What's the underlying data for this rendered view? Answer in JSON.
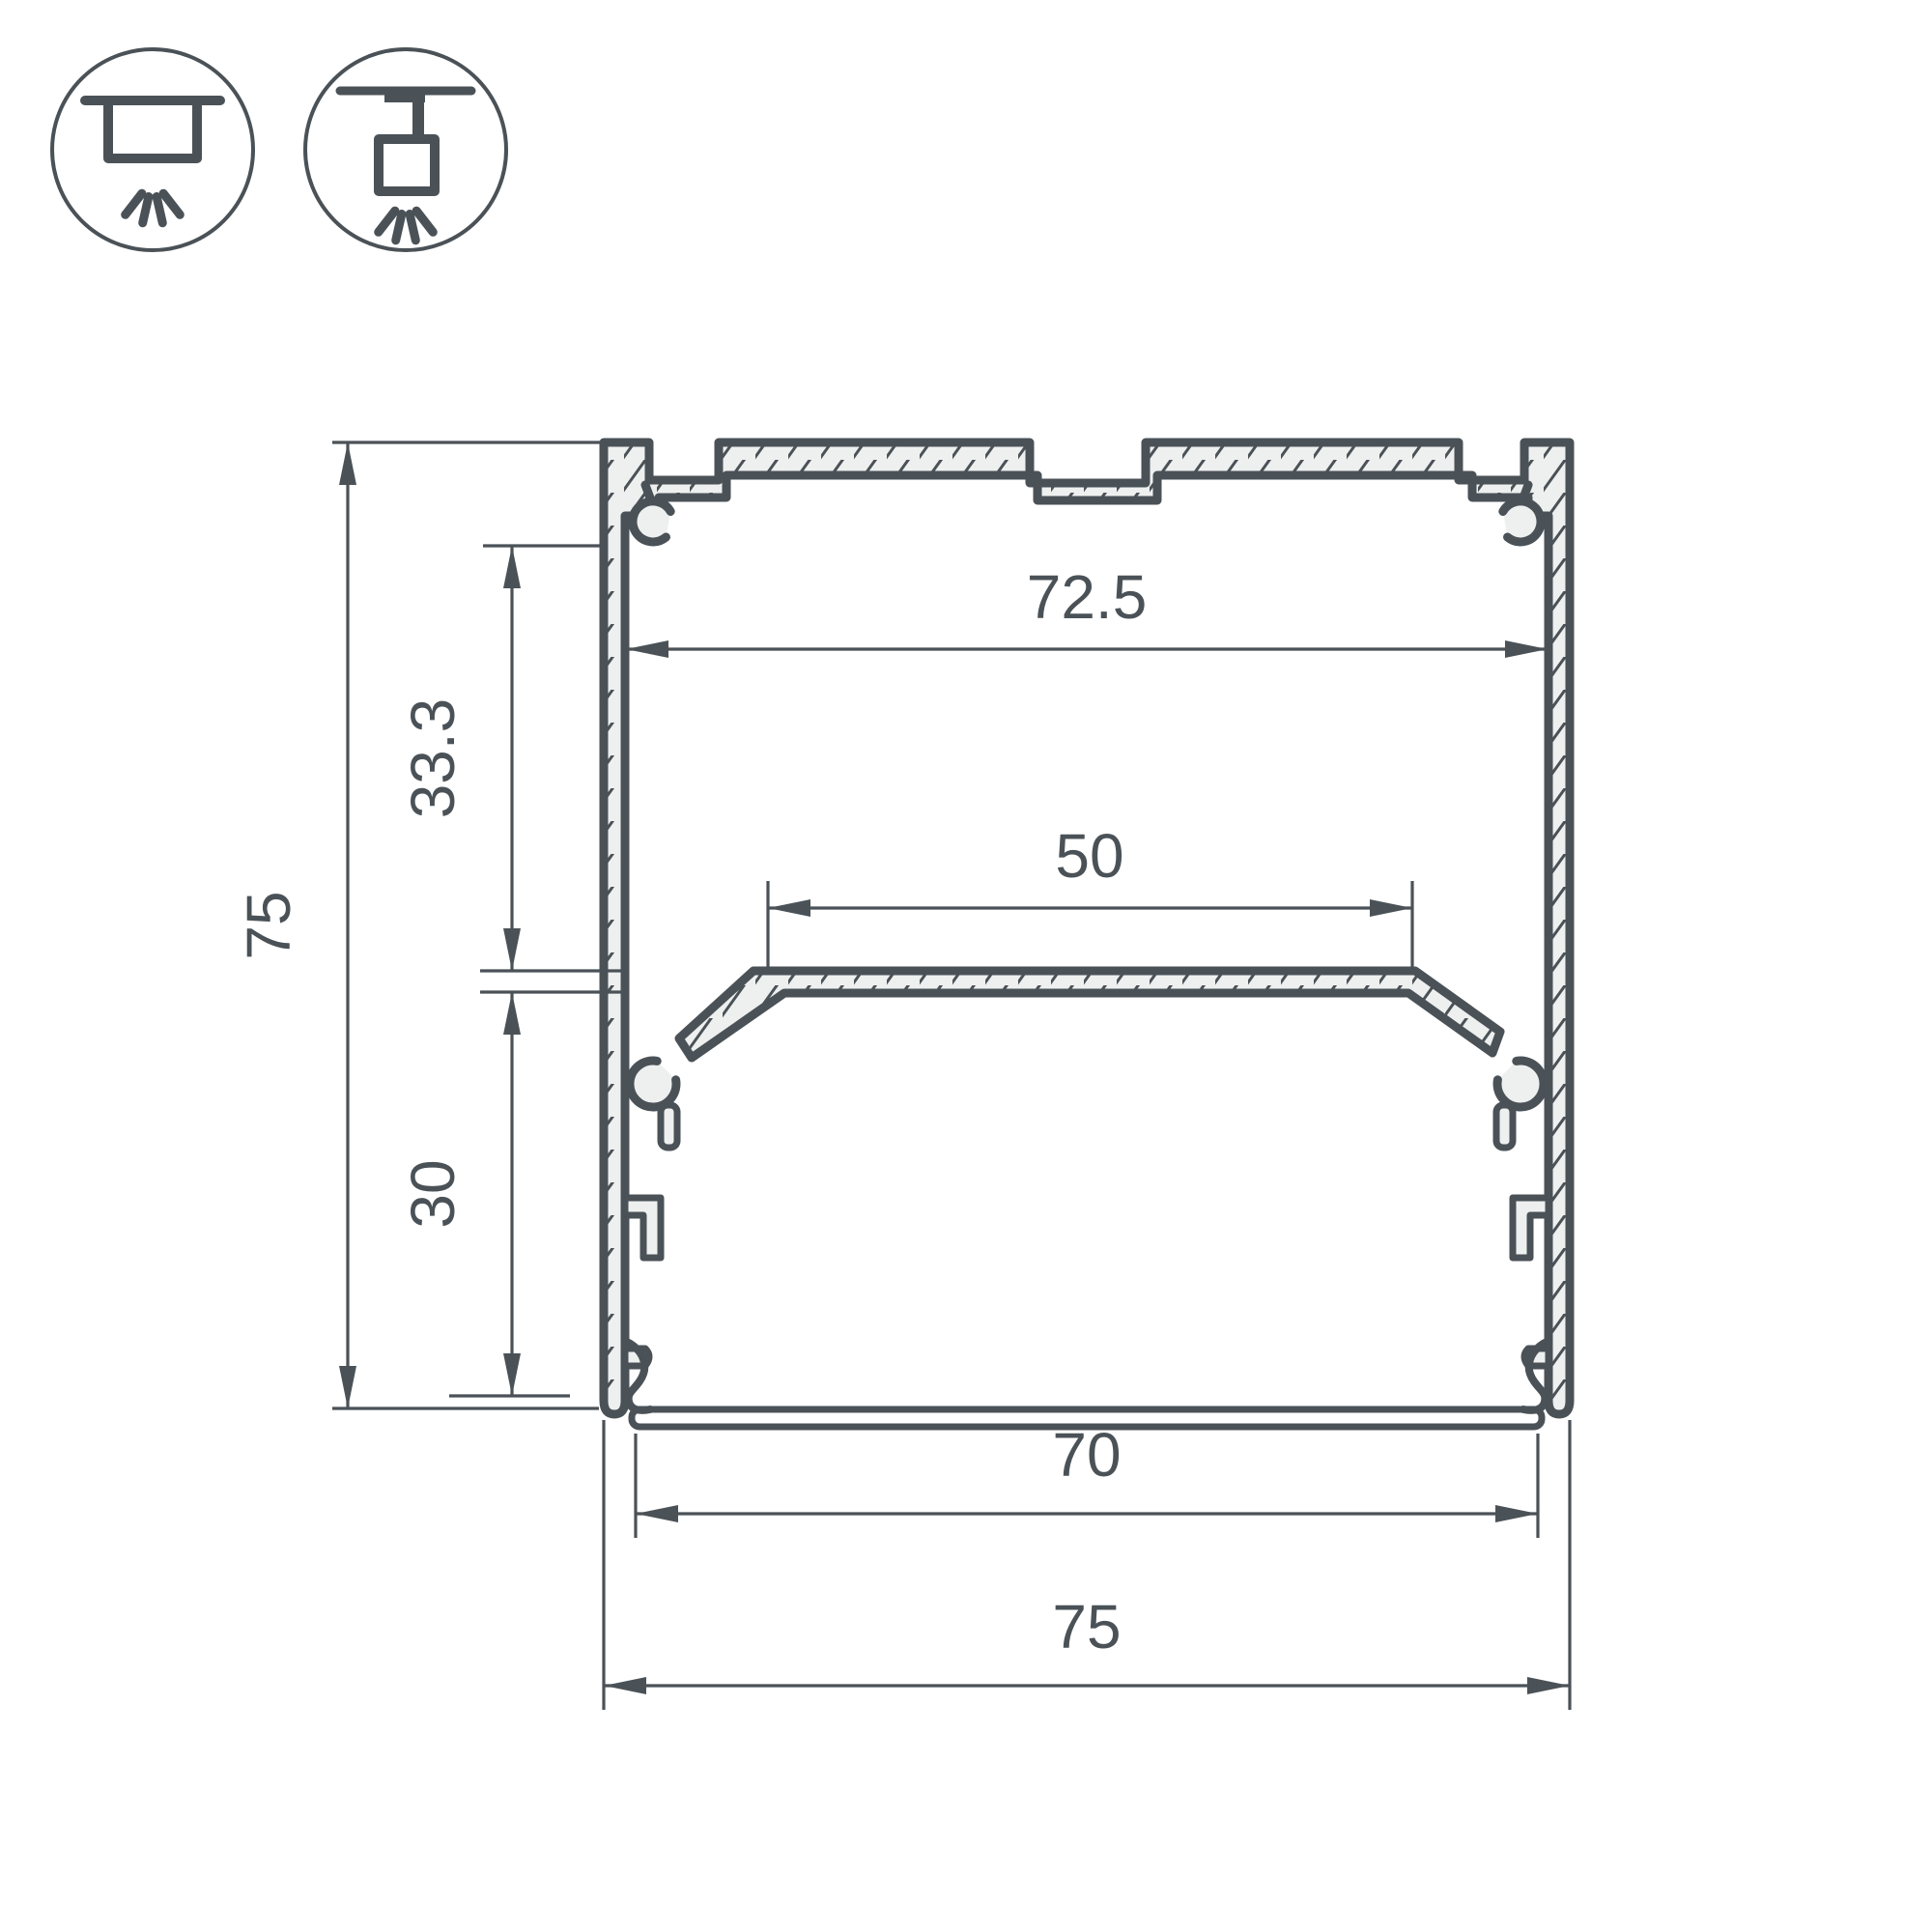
{
  "page": {
    "background": "#ffffff",
    "line_color": "#4b5257",
    "material_fill": "#eef0f0",
    "drawing_type": "aluminum-led-profile-cross-section"
  },
  "icons": {
    "mount_types": [
      {
        "name": "surface-mount-icon",
        "meaning": "surface / ceiling mounted luminaire"
      },
      {
        "name": "pendant-mount-icon",
        "meaning": "suspended / pendant mounted luminaire"
      }
    ]
  },
  "dimensions": {
    "inner_width_top": "72.5",
    "shelf_width": "50",
    "upper_section_height": "33.3",
    "overall_height": "75",
    "lower_section_height": "30",
    "bottom_opening_width": "70",
    "overall_width": "75"
  }
}
